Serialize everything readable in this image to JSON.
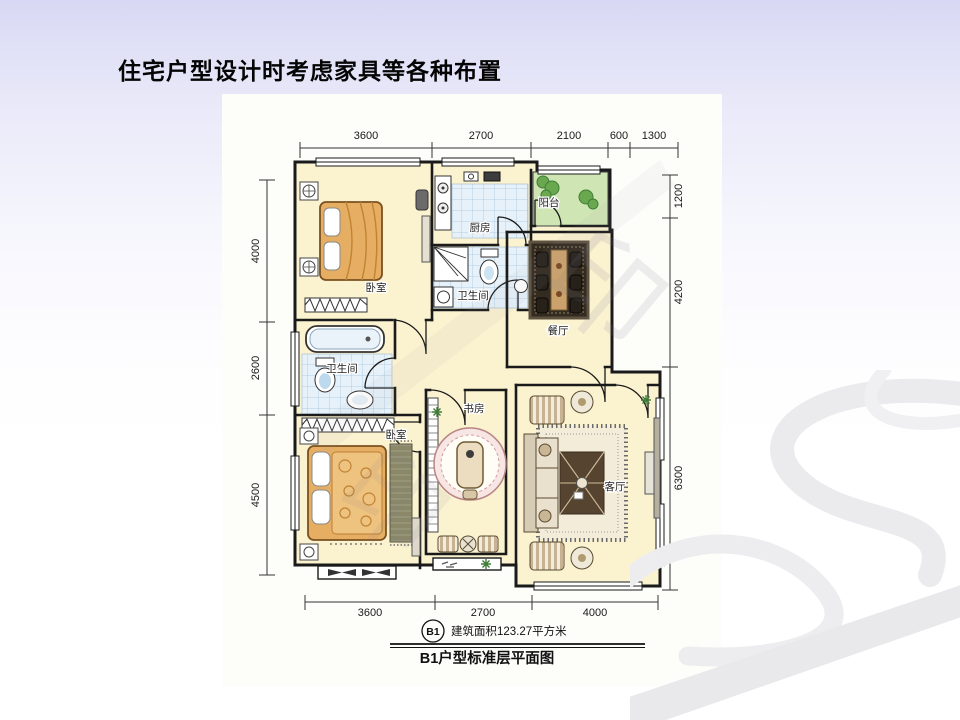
{
  "slide": {
    "title": "住宅户型设计时考虑家具等各种布置"
  },
  "plan": {
    "rooms": [
      {
        "name": "bedroom-1",
        "label": "卧室"
      },
      {
        "name": "kitchen",
        "label": "厨房"
      },
      {
        "name": "balcony",
        "label": "阳台"
      },
      {
        "name": "bathroom-1",
        "label": "卫生间"
      },
      {
        "name": "dining-room",
        "label": "餐厅"
      },
      {
        "name": "bathroom-2",
        "label": "卫生间"
      },
      {
        "name": "bedroom-2",
        "label": "卧室"
      },
      {
        "name": "study",
        "label": "书房"
      },
      {
        "name": "living-room",
        "label": "客厅"
      }
    ],
    "dimensions": {
      "top": [
        "3600",
        "2700",
        "2100",
        "600",
        "1300"
      ],
      "bottom": [
        "3600",
        "2700",
        "4000"
      ],
      "left": [
        "4000",
        "2600",
        "4500"
      ],
      "right": [
        "1200",
        "4200",
        "6300"
      ]
    },
    "caption": {
      "badge": "B1",
      "area": "建筑面积123.27平方米",
      "title": "B1户型标准层平面图"
    },
    "watermark": "印",
    "colors": {
      "room_fill": "#fbf2d0",
      "tile_fill": "#e7f1f9",
      "balcony_fill": "#cfe5b4",
      "wall": "#1a1a1a",
      "background_top": "#d8d8f4"
    }
  }
}
